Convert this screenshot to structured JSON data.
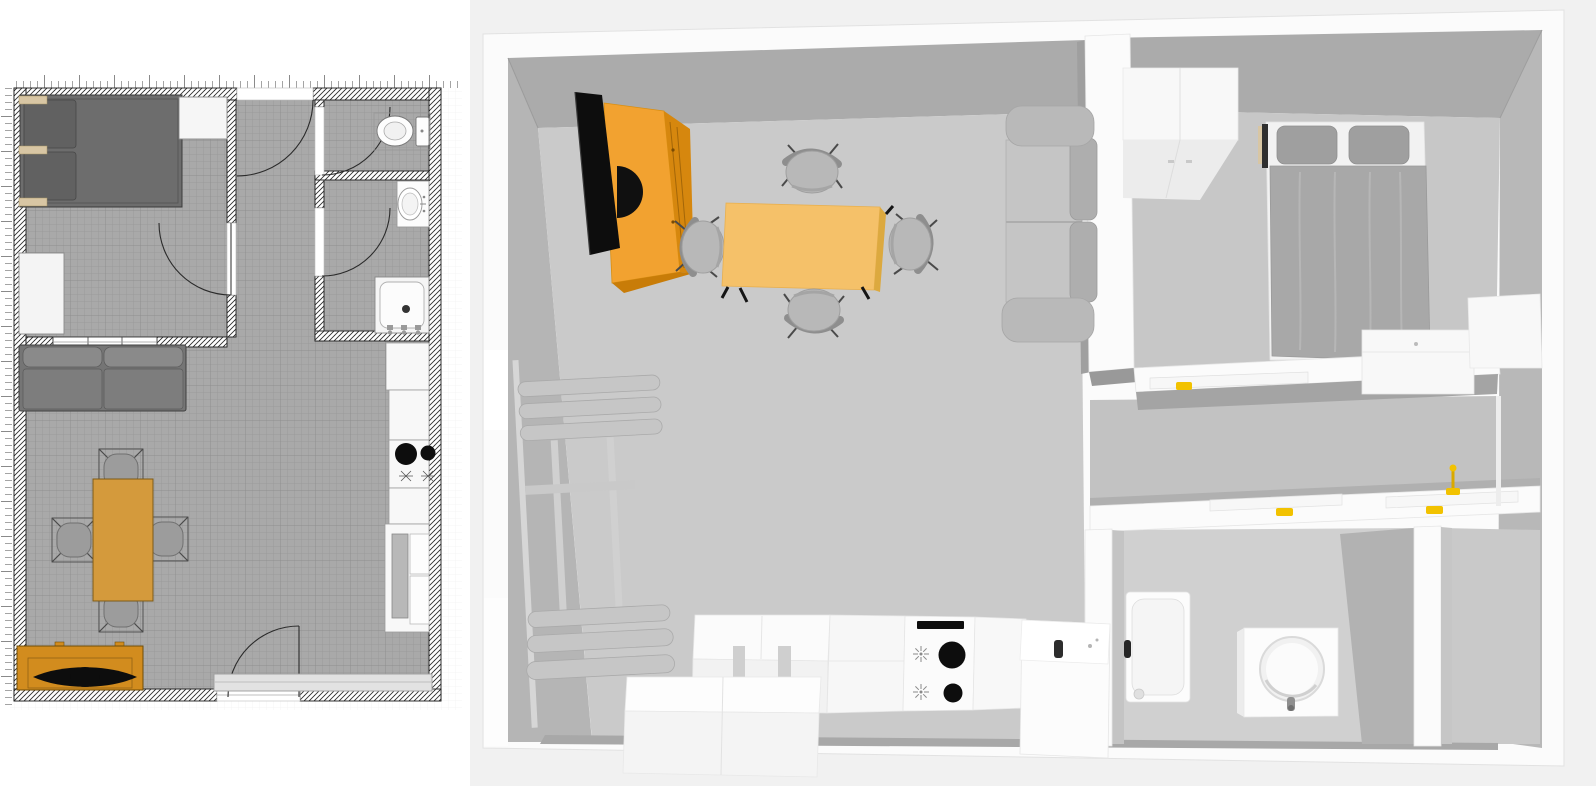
{
  "app": {
    "kind": "home-design-tool",
    "views": [
      {
        "id": "plan-2d",
        "description": "2d-floor-plan-with-rulers"
      },
      {
        "id": "view-3d",
        "description": "3d-overhead-render"
      }
    ]
  },
  "plan2d": {
    "rooms": [
      "bedroom",
      "hallway",
      "toilet-room",
      "bathroom",
      "living-room-kitchen"
    ],
    "furniture": [
      "double-bed",
      "wardrobe",
      "closet",
      "sofa",
      "dining-table",
      "dining-chair-top",
      "dining-chair-left",
      "dining-chair-right",
      "dining-chair-bottom",
      "tv-cabinet",
      "tv",
      "kitchen-unit",
      "kitchen-unit",
      "cooktop",
      "kitchen-unit",
      "kitchen-sink-unit",
      "radiator",
      "toilet",
      "washbasin",
      "shower"
    ],
    "doors": [
      "hallway-door",
      "bedroom-door",
      "toilet-door",
      "bathroom-door",
      "entrance-door"
    ],
    "windows": [
      "interior-window"
    ]
  },
  "view3d": {
    "furniture": [
      "tv",
      "tv-cabinet",
      "dining-table",
      "dining-chairs",
      "sofa",
      "wall-niches",
      "radiator",
      "kitchen-counter",
      "low-chest",
      "cooktop",
      "kitchen-counter",
      "washing-machine",
      "wardrobe",
      "double-bed",
      "foot-chest",
      "corner-cabinet",
      "shower-tray",
      "washbasin",
      "open-door-panels",
      "faucet"
    ]
  },
  "colors": {
    "bg": "#ffffff",
    "bg3d": "#f1f1f1",
    "ink": "#1d1d1d",
    "floor2d": "#a9a9a9",
    "wallTop": "#fbfbfb",
    "wallFace": "#ababab",
    "wallFaceLight": "#b5b5b5",
    "floor3d": "#cacaca",
    "floorBedroom": "#c7c7c7",
    "floorBath": "#d0d0d0",
    "wood2d": "#d49a3c",
    "cabinet2d": "#d28c1e",
    "wood3d": "#f2a230",
    "wood3dFace": "#d6870e",
    "table3d": "#f5c169",
    "handleYellow": "#f2c200",
    "dark": "#0d0d0d",
    "bedGray2d": "#6d6d6d",
    "sofaGray2d": "#757575",
    "fabric3d": "#a8a8a8",
    "chairGray": "#b8b8b8",
    "beige": "#d8c6a4",
    "white": "#f8f8f8"
  }
}
